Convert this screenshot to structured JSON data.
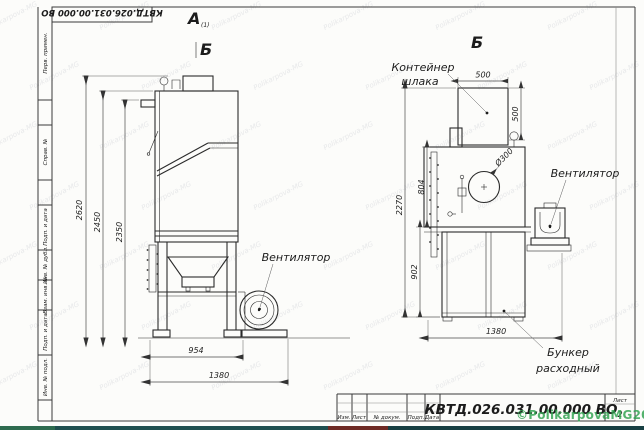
{
  "doc": {
    "code": "КВТД.026.031.00.000 ВО",
    "sheet_label": "Лист",
    "sheet_number": "2",
    "stamp_columns": [
      "Изм.",
      "Лист",
      "№ докум.",
      "Подп.",
      "Дата"
    ],
    "sidebar_labels": [
      "Перв. примен.",
      "Справ. №",
      "Подп. и дата",
      "Инв. № дубл.",
      "Взам. инв. №",
      "Подп. и дата",
      "Инв. № подл."
    ]
  },
  "views": {
    "view_a_label": "А",
    "view_a_sub": "(1)",
    "view_b_left_label": "Б",
    "view_b_right_label": "Б"
  },
  "labels": {
    "fan_left": "Вентилятор",
    "fan_right": "Вентилятор",
    "slag_container_line1": "Контейнер",
    "slag_container_line2": "шлака",
    "hopper_line1": "Бункер",
    "hopper_line2": "расходный",
    "hole_diameter": "Ø300"
  },
  "dimensions": {
    "left_view": {
      "height_outer": "2620",
      "height_mid": "2450",
      "height_inner": "2350",
      "width_body": "954",
      "width_total": "1380"
    },
    "right_view": {
      "container_width": "500",
      "container_height": "500",
      "body_height": "804",
      "total_height": "2270",
      "hopper_height": "902",
      "width_total": "1380"
    }
  },
  "watermark": {
    "tile_text": "Polikarpova-MG",
    "copyright": "©PolikarpovaMG2021",
    "copyright_color": "#2fa24f"
  }
}
